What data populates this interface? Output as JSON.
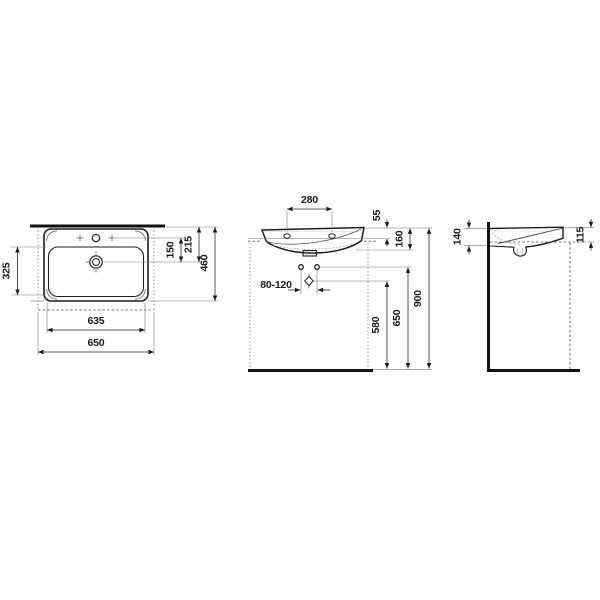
{
  "drawing_title": "Washbasin technical dimension drawing",
  "colors": {
    "background": "#ffffff",
    "line": "#1c1c1c"
  },
  "views": {
    "top_view": {
      "name": "Top view (plan)",
      "dims": {
        "tap_to_drain": "150",
        "drain_from_wall": "215",
        "total_depth": "460",
        "bowl_depth": "325",
        "inner_width": "635",
        "total_width": "650"
      }
    },
    "front_view": {
      "name": "Front view",
      "dims": {
        "tap_hole_spacing": "280",
        "rim_to_ledge": "55",
        "basin_height": "160",
        "bolt_spacing": "80-120",
        "outlet_height": "580",
        "bolt_height": "650",
        "rim_height": "900"
      }
    },
    "side_view": {
      "name": "Side view (section)",
      "dims": {
        "back_height": "140",
        "front_height": "115"
      }
    }
  }
}
